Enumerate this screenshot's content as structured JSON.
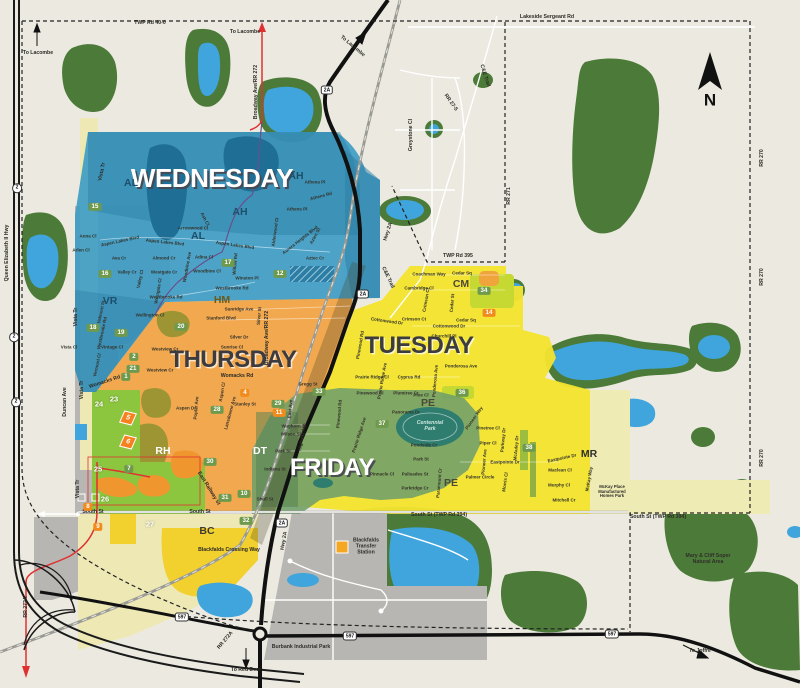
{
  "colors": {
    "base": "#ECEAE0",
    "forest": "#4C7A38",
    "water": "#3FA5DC",
    "pond-dark": "#1F6E96",
    "zone-wednesday": "#3E9CC4",
    "zone-wednesday-dark": "#2C7EA4",
    "zone-thursday": "#F2A84E",
    "zone-tuesday": "#F2E32F",
    "zone-friday": "#6F9E6A",
    "zone-lime": "#8CC63F",
    "zone-gray": "#B7B6B2",
    "zone-pale": "#EFEBB5",
    "bright-yellow": "#F2D02E",
    "badge-green": "#6F9A4D",
    "badge-orange": "#F08C1E",
    "road-red": "#E03131",
    "park-teal": "#2E7D6F"
  },
  "zone_titles": [
    {
      "t": "WEDNESDAY",
      "x": 212,
      "y": 178,
      "s": 26,
      "k": "light"
    },
    {
      "t": "THURSDAY",
      "x": 233,
      "y": 360,
      "s": 24,
      "k": "dark"
    },
    {
      "t": "TUESDAY",
      "x": 419,
      "y": 346,
      "s": 24,
      "k": "dark"
    },
    {
      "t": "FRIDAY",
      "x": 332,
      "y": 468,
      "s": 24,
      "k": "light"
    }
  ],
  "area_codes": [
    {
      "t": "AL",
      "x": 131,
      "y": 184,
      "c": "#1C4F6B"
    },
    {
      "t": "AH",
      "x": 296,
      "y": 177,
      "c": "#1C4F6B"
    },
    {
      "t": "AH",
      "x": 240,
      "y": 213,
      "c": "#1C4F6B"
    },
    {
      "t": "AL",
      "x": 198,
      "y": 237,
      "c": "#1C4F6B"
    },
    {
      "t": "VR",
      "x": 110,
      "y": 302,
      "c": "#1C4F6B"
    },
    {
      "t": "HM",
      "x": 222,
      "y": 301,
      "c": "#6B5B1E"
    },
    {
      "t": "CM",
      "x": 461,
      "y": 285,
      "c": "#4A4A38"
    },
    {
      "t": "PE",
      "x": 428,
      "y": 404,
      "c": "#4A4A38"
    },
    {
      "t": "PE",
      "x": 451,
      "y": 484,
      "c": "#4A4A38"
    },
    {
      "t": "DT",
      "x": 260,
      "y": 452,
      "c": "#FFFFFF"
    },
    {
      "t": "RH",
      "x": 163,
      "y": 452,
      "c": "#FFFFFF"
    },
    {
      "t": "BC",
      "x": 207,
      "y": 532,
      "c": "#3C3C34"
    },
    {
      "t": "MR",
      "x": 589,
      "y": 455,
      "c": "#2F2F2F"
    }
  ],
  "road_labels": [
    {
      "t": "TWP Rd 40-0",
      "x": 150,
      "y": 24
    },
    {
      "t": "Lakeside Sergeant Rd",
      "x": 547,
      "y": 18
    },
    {
      "t": "To Lacombe",
      "x": 38,
      "y": 54
    },
    {
      "t": "To Lacombe",
      "x": 245,
      "y": 33
    },
    {
      "t": "To Lacombe",
      "x": 352,
      "y": 47,
      "r": 40
    },
    {
      "t": "Broadway Ave/RR 272",
      "x": 257,
      "y": 92,
      "r": -90
    },
    {
      "t": "Broadway Ave/RR 272",
      "x": 268,
      "y": 338,
      "r": -90
    },
    {
      "t": "Queen Elizabeth II Hwy",
      "x": 8,
      "y": 253,
      "r": -90
    },
    {
      "t": "C&E Trail",
      "x": 484,
      "y": 76,
      "r": 72
    },
    {
      "t": "C&E Trail",
      "x": 387,
      "y": 278,
      "r": 65
    },
    {
      "t": "RR 27-5",
      "x": 450,
      "y": 103,
      "r": 55
    },
    {
      "t": "Greystone Cl",
      "x": 412,
      "y": 135,
      "r": -90
    },
    {
      "t": "TWP Rd 395",
      "x": 458,
      "y": 257
    },
    {
      "t": "RR 271",
      "x": 510,
      "y": 196,
      "r": -90
    },
    {
      "t": "RR 270",
      "x": 763,
      "y": 158,
      "r": -90
    },
    {
      "t": "RR 270",
      "x": 763,
      "y": 277,
      "r": -90
    },
    {
      "t": "RR 270",
      "x": 763,
      "y": 458,
      "r": -90
    },
    {
      "t": "Hwy 2A",
      "x": 389,
      "y": 232,
      "r": -72
    },
    {
      "t": "Hwy 2A",
      "x": 285,
      "y": 541,
      "r": -80
    },
    {
      "t": "South St",
      "x": 93,
      "y": 513
    },
    {
      "t": "South St",
      "x": 200,
      "y": 513
    },
    {
      "t": "South St (TWP Rd 394)",
      "x": 439,
      "y": 516
    },
    {
      "t": "South St (TWP Rd 394)",
      "x": 658,
      "y": 518
    },
    {
      "t": "Womacks Rd",
      "x": 105,
      "y": 383,
      "r": -18
    },
    {
      "t": "Womacks Rd",
      "x": 237,
      "y": 377
    },
    {
      "t": "East Railway St",
      "x": 208,
      "y": 489,
      "r": 58
    },
    {
      "t": "Duncan Ave",
      "x": 66,
      "y": 402,
      "r": -90
    },
    {
      "t": "Vista Tr",
      "x": 77,
      "y": 317,
      "r": -90
    },
    {
      "t": "Vista Tr",
      "x": 83,
      "y": 390,
      "r": -90
    },
    {
      "t": "Vista Tr",
      "x": 79,
      "y": 489,
      "r": -90
    },
    {
      "t": "Vista Tr",
      "x": 103,
      "y": 172,
      "r": -78
    },
    {
      "t": "RR 272A",
      "x": 27,
      "y": 607,
      "r": -90
    },
    {
      "t": "RR 272A",
      "x": 226,
      "y": 641,
      "r": -50
    },
    {
      "t": "To Red Deer",
      "x": 246,
      "y": 671
    },
    {
      "t": "To Joffre",
      "x": 700,
      "y": 652
    },
    {
      "t": "Blackfalds Crossing Way",
      "x": 229,
      "y": 551
    }
  ],
  "street_labels": [
    {
      "t": "Anna Cl",
      "x": 88,
      "y": 236
    },
    {
      "t": "Aspen Lakes Blvd",
      "x": 120,
      "y": 241,
      "r": -12
    },
    {
      "t": "Arlen Cl",
      "x": 81,
      "y": 250
    },
    {
      "t": "Ava Cr",
      "x": 119,
      "y": 258
    },
    {
      "t": "Valley Cr",
      "x": 127,
      "y": 272
    },
    {
      "t": "Valley Cl",
      "x": 140,
      "y": 279,
      "r": -78
    },
    {
      "t": "Westgate Cr",
      "x": 164,
      "y": 272
    },
    {
      "t": "Westgate Cl",
      "x": 158,
      "y": 291,
      "r": -80
    },
    {
      "t": "Almond Cr",
      "x": 164,
      "y": 258
    },
    {
      "t": "Adina Cl",
      "x": 204,
      "y": 257
    },
    {
      "t": "Woodbine Cl",
      "x": 207,
      "y": 271
    },
    {
      "t": "Woodbine Ave",
      "x": 187,
      "y": 267,
      "r": -80
    },
    {
      "t": "Arrowwood Cl",
      "x": 193,
      "y": 228
    },
    {
      "t": "Ash Cl",
      "x": 205,
      "y": 219,
      "r": 62
    },
    {
      "t": "Aspen Lakes Blvd",
      "x": 165,
      "y": 242,
      "r": 6
    },
    {
      "t": "Aspen Lakes Blvd",
      "x": 235,
      "y": 245,
      "r": 8
    },
    {
      "t": "Athena Pl",
      "x": 315,
      "y": 182
    },
    {
      "t": "Athens Rd",
      "x": 321,
      "y": 196,
      "r": -15
    },
    {
      "t": "Athens Pl",
      "x": 297,
      "y": 209
    },
    {
      "t": "Alderwood Cl",
      "x": 275,
      "y": 232,
      "r": -82
    },
    {
      "t": "Aurora Heights Blvd",
      "x": 300,
      "y": 240,
      "r": -38
    },
    {
      "t": "Aztec St",
      "x": 315,
      "y": 236,
      "r": -62
    },
    {
      "t": "Aztec Cr",
      "x": 315,
      "y": 258
    },
    {
      "t": "Winston Pl",
      "x": 247,
      "y": 278
    },
    {
      "t": "Willow Rd",
      "x": 235,
      "y": 264,
      "r": -85
    },
    {
      "t": "Westbrooke Rd",
      "x": 232,
      "y": 288
    },
    {
      "t": "Westbrooke Rd",
      "x": 166,
      "y": 297
    },
    {
      "t": "Wellington Cl",
      "x": 150,
      "y": 315
    },
    {
      "t": "Valmont St",
      "x": 101,
      "y": 312,
      "r": -78
    },
    {
      "t": "Westbrooke Rd",
      "x": 102,
      "y": 333,
      "r": -78
    },
    {
      "t": "Vintage Cl",
      "x": 112,
      "y": 347
    },
    {
      "t": "Vermont Cl",
      "x": 97,
      "y": 365,
      "r": -78
    },
    {
      "t": "Vista Cl",
      "x": 69,
      "y": 347
    },
    {
      "t": "Sunridge Ave",
      "x": 239,
      "y": 309
    },
    {
      "t": "Stanford Blvd",
      "x": 221,
      "y": 318
    },
    {
      "t": "Silver Dr",
      "x": 239,
      "y": 337
    },
    {
      "t": "Silver St",
      "x": 259,
      "y": 316,
      "r": -85
    },
    {
      "t": "Sunrise Cl",
      "x": 232,
      "y": 347
    },
    {
      "t": "Westview Cr",
      "x": 165,
      "y": 349
    },
    {
      "t": "Westview Cr",
      "x": 160,
      "y": 370
    },
    {
      "t": "Gregg St",
      "x": 308,
      "y": 384
    },
    {
      "t": "Stanley St",
      "x": 245,
      "y": 404
    },
    {
      "t": "Aspen Dr",
      "x": 186,
      "y": 408
    },
    {
      "t": "Aspen Cl",
      "x": 222,
      "y": 392,
      "r": -80
    },
    {
      "t": "Poplar Ave",
      "x": 196,
      "y": 408,
      "r": -85
    },
    {
      "t": "Lansdowne Ave",
      "x": 230,
      "y": 413,
      "r": -75
    },
    {
      "t": "Waghorn St",
      "x": 294,
      "y": 426
    },
    {
      "t": "Wilson St",
      "x": 291,
      "y": 434
    },
    {
      "t": "Park St",
      "x": 283,
      "y": 451
    },
    {
      "t": "East Ave",
      "x": 290,
      "y": 409,
      "r": -85
    },
    {
      "t": "Highway Ave",
      "x": 302,
      "y": 437,
      "r": -80
    },
    {
      "t": "Indiana St",
      "x": 275,
      "y": 469
    },
    {
      "t": "Shull St",
      "x": 265,
      "y": 499
    },
    {
      "t": "Panorama Dr",
      "x": 406,
      "y": 412
    },
    {
      "t": "Pondside Cr",
      "x": 424,
      "y": 445
    },
    {
      "t": "Park St",
      "x": 421,
      "y": 459
    },
    {
      "t": "Palisades St",
      "x": 415,
      "y": 474
    },
    {
      "t": "Parkridge Cr",
      "x": 415,
      "y": 488
    },
    {
      "t": "Pinnacle Cl",
      "x": 382,
      "y": 474
    },
    {
      "t": "Paramount Cr",
      "x": 439,
      "y": 483,
      "r": -85
    },
    {
      "t": "Prairie Ridge Ave",
      "x": 359,
      "y": 435,
      "r": -72
    },
    {
      "t": "Pinewood Rd",
      "x": 339,
      "y": 414,
      "r": -85
    },
    {
      "t": "Coachman Way",
      "x": 429,
      "y": 274
    },
    {
      "t": "Cedar Sq",
      "x": 462,
      "y": 273
    },
    {
      "t": "Cambridge Cl",
      "x": 419,
      "y": 288
    },
    {
      "t": "Crimson Cl",
      "x": 426,
      "y": 300,
      "r": -80
    },
    {
      "t": "Crimson Ct",
      "x": 414,
      "y": 319
    },
    {
      "t": "Cottonwood Dr",
      "x": 449,
      "y": 326
    },
    {
      "t": "Cottonwood Dr",
      "x": 387,
      "y": 321,
      "r": 8
    },
    {
      "t": "Churchill Pl",
      "x": 444,
      "y": 336
    },
    {
      "t": "Cedar Sq",
      "x": 466,
      "y": 320
    },
    {
      "t": "Cedar St",
      "x": 452,
      "y": 303,
      "r": -85
    },
    {
      "t": "Ponderosa Ave",
      "x": 461,
      "y": 366
    },
    {
      "t": "Ponderosa Ave",
      "x": 435,
      "y": 381,
      "r": -85
    },
    {
      "t": "Cyprus Rd",
      "x": 409,
      "y": 377
    },
    {
      "t": "Plumtree Cr",
      "x": 406,
      "y": 393
    },
    {
      "t": "Prairie Ridge Ave",
      "x": 382,
      "y": 381,
      "r": -80
    },
    {
      "t": "Prairie Ridge Cl",
      "x": 372,
      "y": 377
    },
    {
      "t": "Pinewood Cl",
      "x": 370,
      "y": 393
    },
    {
      "t": "Pinewood Rd",
      "x": 360,
      "y": 345,
      "r": -80
    },
    {
      "t": "Pine Cl",
      "x": 421,
      "y": 395
    },
    {
      "t": "Pinetree Cl",
      "x": 488,
      "y": 428
    },
    {
      "t": "Piper Cl",
      "x": 488,
      "y": 443
    },
    {
      "t": "Parkway Dr",
      "x": 503,
      "y": 440,
      "r": -85
    },
    {
      "t": "Pioneer Ave",
      "x": 484,
      "y": 462,
      "r": -85
    },
    {
      "t": "Pioneer Way",
      "x": 474,
      "y": 418,
      "r": -55
    },
    {
      "t": "Eastpointe Dr",
      "x": 505,
      "y": 462
    },
    {
      "t": "Eastpointe Dr",
      "x": 562,
      "y": 458,
      "r": -12
    },
    {
      "t": "Palmer Circle",
      "x": 480,
      "y": 477
    },
    {
      "t": "Morris Cl",
      "x": 505,
      "y": 482,
      "r": -82
    },
    {
      "t": "McAuley Dr",
      "x": 516,
      "y": 448,
      "r": -85
    },
    {
      "t": "Maclean Cl",
      "x": 560,
      "y": 470
    },
    {
      "t": "Murphy Cl",
      "x": 559,
      "y": 485
    },
    {
      "t": "Mitchell Cr",
      "x": 564,
      "y": 500
    },
    {
      "t": "McKay Way",
      "x": 589,
      "y": 479,
      "r": -80
    }
  ],
  "place_labels": [
    {
      "t": "Blackfalds\nTransfer\nStation",
      "x": 366,
      "y": 547
    },
    {
      "t": "Burbank Industrial Park",
      "x": 301,
      "y": 648
    },
    {
      "t": "Mary & Cliff Soper\nNatural Area",
      "x": 708,
      "y": 560
    },
    {
      "t": "Centennial\nPark",
      "x": 430,
      "y": 427,
      "c": "#CFE8DF",
      "k": "park-lbl"
    },
    {
      "t": "McKay Place\nManufactured\nHomes Park",
      "x": 612,
      "y": 492,
      "s": 4.2
    },
    {
      "t": "N",
      "x": 710,
      "y": 100,
      "k": "compass-n",
      "s": 17
    }
  ],
  "badges": [
    {
      "t": "15",
      "x": 95,
      "y": 207
    },
    {
      "t": "16",
      "x": 105,
      "y": 274
    },
    {
      "t": "17",
      "x": 228,
      "y": 263
    },
    {
      "t": "12",
      "x": 280,
      "y": 274
    },
    {
      "t": "20",
      "x": 181,
      "y": 327
    },
    {
      "t": "18",
      "x": 93,
      "y": 328
    },
    {
      "t": "19",
      "x": 121,
      "y": 333
    },
    {
      "t": "2",
      "x": 134,
      "y": 357
    },
    {
      "t": "21",
      "x": 133,
      "y": 369
    },
    {
      "t": "1",
      "x": 126,
      "y": 377
    },
    {
      "t": "24",
      "x": 99,
      "y": 404,
      "k": "b-p"
    },
    {
      "t": "23",
      "x": 114,
      "y": 399,
      "k": "b-p"
    },
    {
      "t": "28",
      "x": 217,
      "y": 410
    },
    {
      "t": "4",
      "x": 245,
      "y": 393,
      "k": "b-o"
    },
    {
      "t": "33",
      "x": 319,
      "y": 392
    },
    {
      "t": "29",
      "x": 278,
      "y": 404
    },
    {
      "t": "11",
      "x": 279,
      "y": 413,
      "k": "b-o"
    },
    {
      "t": "25",
      "x": 98,
      "y": 469,
      "k": "b-p"
    },
    {
      "t": "7",
      "x": 129,
      "y": 469
    },
    {
      "t": "26",
      "x": 105,
      "y": 499,
      "k": "b-p"
    },
    {
      "t": "8",
      "x": 88,
      "y": 507,
      "k": "b-o"
    },
    {
      "t": "9",
      "x": 98,
      "y": 527,
      "k": "b-o"
    },
    {
      "t": "27",
      "x": 150,
      "y": 524,
      "k": "b-p"
    },
    {
      "t": "30",
      "x": 210,
      "y": 462
    },
    {
      "t": "10",
      "x": 244,
      "y": 494
    },
    {
      "t": "31",
      "x": 225,
      "y": 498
    },
    {
      "t": "32",
      "x": 246,
      "y": 521
    },
    {
      "t": "34",
      "x": 484,
      "y": 291
    },
    {
      "t": "14",
      "x": 489,
      "y": 313,
      "k": "b-o"
    },
    {
      "t": "36",
      "x": 462,
      "y": 393
    },
    {
      "t": "37",
      "x": 382,
      "y": 424
    },
    {
      "t": "38",
      "x": 529,
      "y": 448
    }
  ],
  "pylon_markers": [
    {
      "t": "5",
      "x": 128,
      "y": 418,
      "r": 14
    },
    {
      "t": "6",
      "x": 128,
      "y": 442,
      "r": 14
    }
  ],
  "shields": [
    {
      "t": "2A",
      "x": 327,
      "y": 90
    },
    {
      "t": "2A",
      "x": 363,
      "y": 294
    },
    {
      "t": "2A",
      "x": 282,
      "y": 523
    },
    {
      "t": "597",
      "x": 182,
      "y": 617
    },
    {
      "t": "597",
      "x": 350,
      "y": 636
    },
    {
      "t": "597",
      "x": 612,
      "y": 634
    }
  ],
  "oval_shields": [
    {
      "t": "2",
      "x": 17,
      "y": 188
    },
    {
      "t": "2",
      "x": 14,
      "y": 337
    },
    {
      "t": "2",
      "x": 16,
      "y": 402
    }
  ]
}
